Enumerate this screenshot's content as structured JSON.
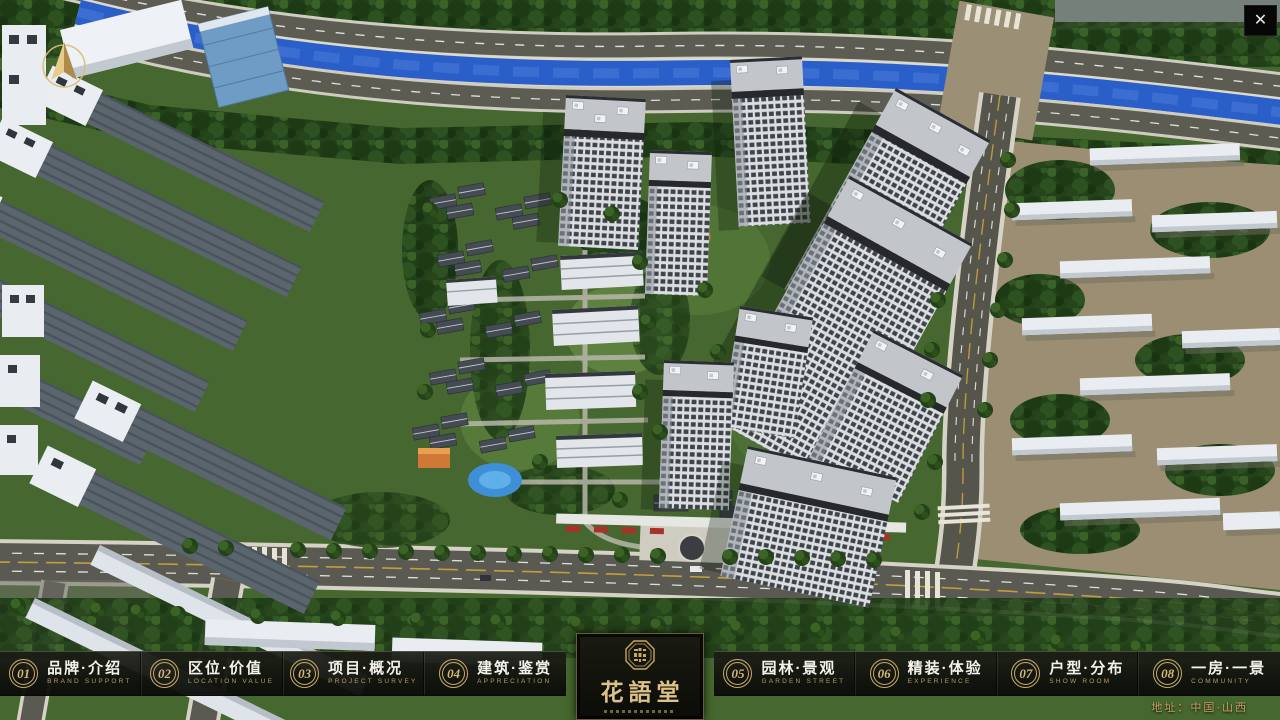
{
  "window": {
    "close_label": "✕"
  },
  "nav": {
    "items": [
      {
        "num": "01",
        "label": "品牌·介绍",
        "caption": "BRAND SUPPORT"
      },
      {
        "num": "02",
        "label": "区位·价值",
        "caption": "LOCATION VALUE"
      },
      {
        "num": "03",
        "label": "项目·概况",
        "caption": "PROJECT SURVEY"
      },
      {
        "num": "04",
        "label": "建筑·鉴赏",
        "caption": "APPRECIATION"
      },
      {
        "num": "05",
        "label": "园林·景观",
        "caption": "GARDEN STREET"
      },
      {
        "num": "06",
        "label": "精装·体验",
        "caption": "EXPERIENCE"
      },
      {
        "num": "07",
        "label": "户型·分布",
        "caption": "SHOW ROOM"
      },
      {
        "num": "08",
        "label": "一房·一景",
        "caption": "COMMUNITY"
      }
    ]
  },
  "logo": {
    "title": "花語堂"
  },
  "footer": {
    "address": "地址：中国·山西"
  },
  "colors": {
    "accent_gold": "#c9a96a",
    "river_blue": "#2a5ec9",
    "panel_dark": "#14160f"
  }
}
